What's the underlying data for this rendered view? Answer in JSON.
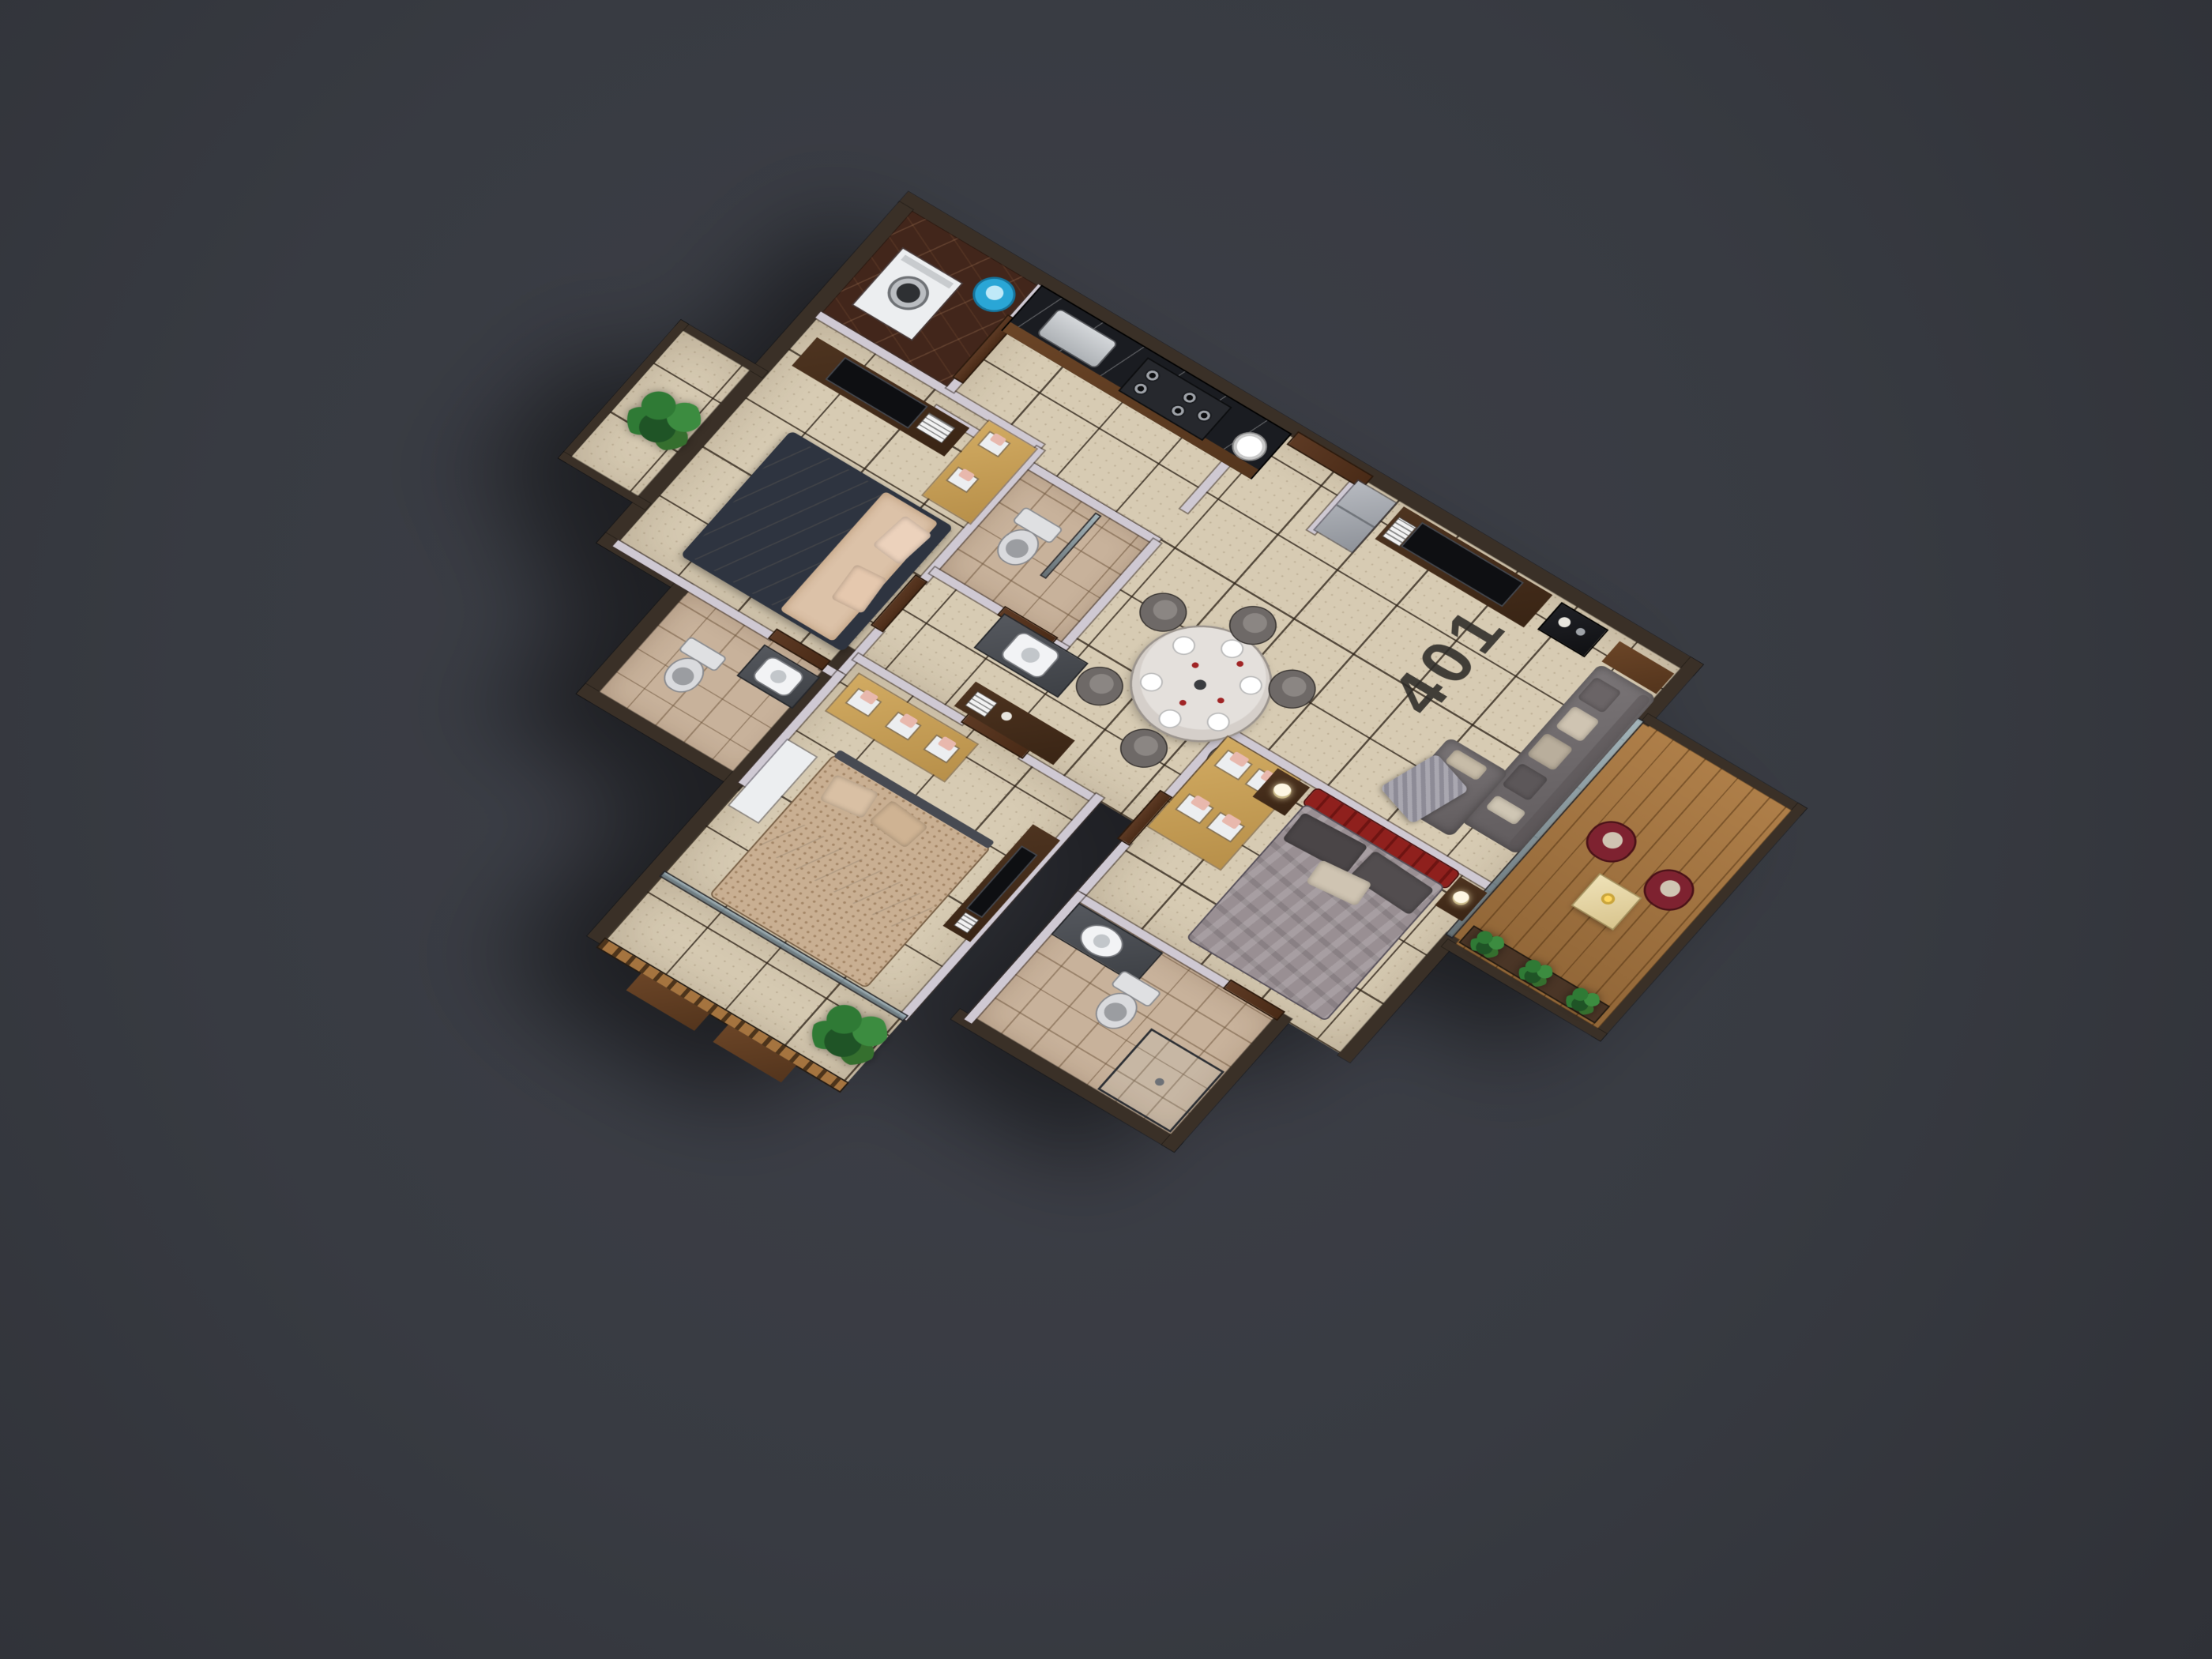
{
  "unit": {
    "label": "401"
  },
  "scene": {
    "type": "isometric-3d-floor-plan",
    "rooms": [
      "utility",
      "kitchen",
      "entry-foyer",
      "living-room",
      "dining-area",
      "hallway",
      "common-bathroom",
      "bedroom-2",
      "bedroom-2-bathroom",
      "bedroom-3",
      "master-bedroom",
      "master-bathroom",
      "balcony-left",
      "balcony-right",
      "balcony-rear"
    ]
  },
  "colors": {
    "background": "#383b42",
    "bg_light": "#3e4049",
    "bg_dark": "#2f3137",
    "floor_tile": "#d7cbb3",
    "bath_tile": "#c8b29b",
    "marble_dark": "#42261b",
    "counter_black": "#1a1c21",
    "wall_ext": "#3a3027",
    "wall_face": "#cfc9d3",
    "wood": "#6b4527",
    "wood_dark": "#4e3420",
    "wood_light": "#d2ab62",
    "wood_deck": "#a5743f",
    "sofa": "#7b7678",
    "cushion_light": "#cfc4b2",
    "table_top": "#d5cfca",
    "chair": "#6e6967",
    "chair_maroon": "#7e2230",
    "bed_red": "#8f201d",
    "bed_gray": "#998f93",
    "pillow_dark": "#4a4547",
    "bed_beige": "#dcc2a8",
    "bed_pattern": "#c9af92",
    "sheet_white": "#ece7e0",
    "plant": "#2f7a35",
    "plant_dark": "#1f5426",
    "pot": "#4a3526",
    "bucket": "#2aa6d6",
    "fridge": "#b7bac0",
    "appliance_white": "#eceef0",
    "tv": "#0e0f12",
    "door_wood": "#5d3a24",
    "glass": "#9fb4bd",
    "label_color": "#2d2b28"
  }
}
